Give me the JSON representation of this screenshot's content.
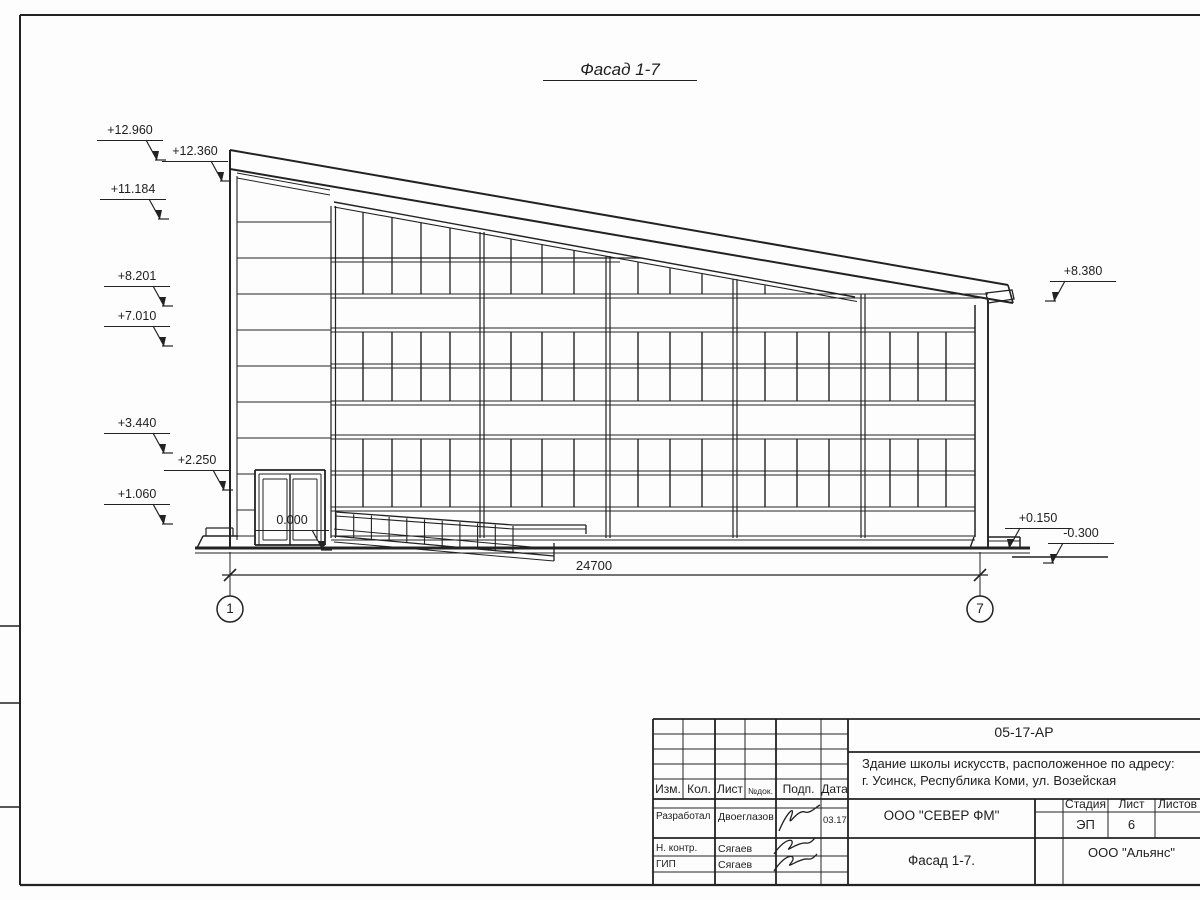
{
  "sheet": {
    "title": "Фасад 1-7",
    "dimension_total": "24700",
    "axis_left": "1",
    "axis_right": "7"
  },
  "elevations": [
    "+12.960",
    "+12.360",
    "+11.184",
    "+8.201",
    "+7.010",
    "+3.440",
    "+2.250",
    "+1.060",
    "0.000",
    "+8.380",
    "+0.150",
    "-0.300"
  ],
  "title_block": {
    "code": "05-17-АР",
    "project_line1": "Здание школы искусств, расположенное по адресу:",
    "project_line2": "г. Усинск, Республика Коми, ул. Возейская",
    "columns": {
      "izm": "Изм.",
      "kol": "Кол.",
      "list": "Лист",
      "ndok": "№док.",
      "podp": "Подп.",
      "data": "Дата"
    },
    "rows": [
      {
        "role": "Разработал",
        "name": "Двоеглазов",
        "date": "03.17"
      },
      {
        "role": "Н. контр.",
        "name": "Сягаев",
        "date": ""
      },
      {
        "role": "ГИП",
        "name": "Сягаев",
        "date": ""
      }
    ],
    "org": "ООО \"СЕВЕР ФМ\"",
    "stage_label": "Стадия",
    "stage": "ЭП",
    "sheet_label": "Лист",
    "sheet_no": "6",
    "sheets_label": "Листов",
    "subtitle": "Фасад 1-7.",
    "client": "ООО \"Альянс\""
  }
}
